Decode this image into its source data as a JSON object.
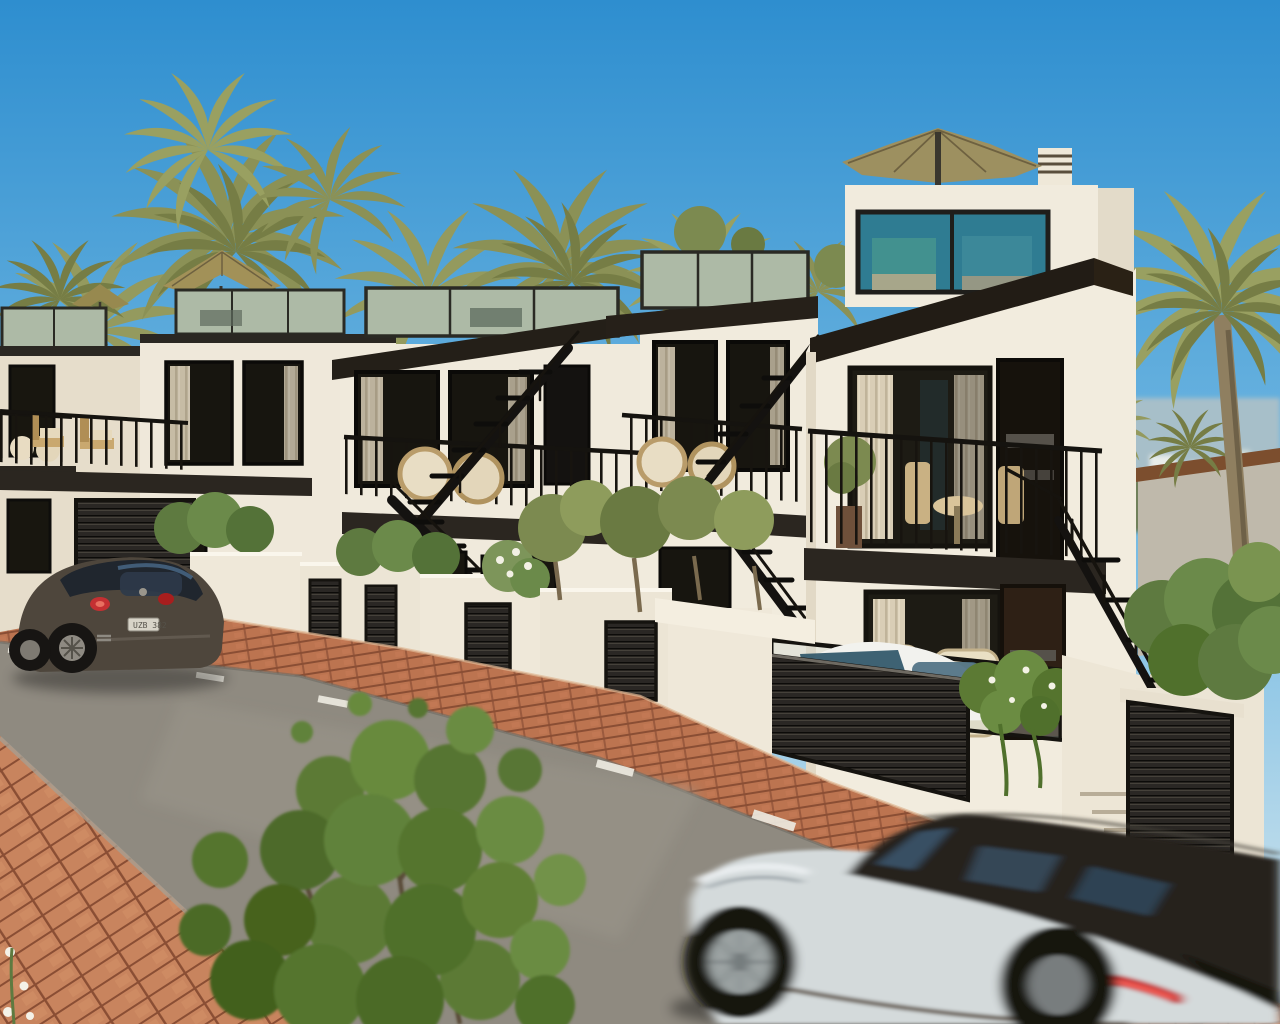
{
  "scene": {
    "type": "photorealistic architectural exterior render",
    "description": "Sunny daytime render of a row of modern white Mediterranean townhouses with rooftop glass terraces, tan patio umbrellas, black metal balconies and external stairs; date palms behind; brick-edged asphalt street in front with a dark VW Beetle parked at left, a motion-blurred white SUV driving past at lower right, and a leafy green bush at lower left.",
    "time_of_day": "bright sunny day",
    "sky": {
      "top": "#2e8ecf",
      "mid": "#7abde4",
      "horizon": "#dcead苏ee"
    }
  },
  "sky": {
    "top": "#2e8ecf",
    "mid": "#7abde4",
    "horizon": "#dceaee"
  },
  "palette": {
    "wall_light": "#f2ecde",
    "wall_shade": "#e6ddcb",
    "slab_dark": "#2b2620",
    "fascia_dark": "#221c15",
    "frame_dark": "#16130e",
    "window_glass": "#1d1b14",
    "glass_sage": "#adbaa6",
    "glass_teal": "#2f7c92",
    "umbrella_tan": "#9d9060",
    "umbrella_dark": "#8a7c4e",
    "palm_olive": "#949a5e",
    "palm_dark": "#767d45",
    "trunk_brown": "#8a7a5e",
    "hedge_green": "#5e7a40",
    "bush_green": "#5c7a34",
    "tree_olive": "#7c8a50",
    "road_asphalt": "#8f8a80",
    "road_dash": "#ece9df",
    "brick_curb": "#bc7450",
    "paver_salmon": "#c8845e",
    "joint_dark": "#8a4e34",
    "hill_blue": "#a7bfc9",
    "coping_brown": "#7c4e2e",
    "beetle_body": "#4e463c",
    "beetle_roof": "#20262e",
    "suv_body": "#d4dadb",
    "suv_glass": "#26241f",
    "taillight_red": "#c43032",
    "chair_cream": "#efe6ce",
    "rattan_tan": "#c9b183",
    "louver_dark": "#2a2724"
  },
  "vehicles": {
    "beetle": {
      "kind": "parked dark hatchback (Beetle style)",
      "plate": "UZB 382"
    },
    "suv": {
      "kind": "white SUV driving past, motion-blurred"
    }
  },
  "buildings": {
    "count": 5,
    "style": "modern cubic white townhouses stepping uphill to the right",
    "features": [
      "rooftop glass balustrades",
      "tan patio umbrellas",
      "black metal balcony railings",
      "external black staircases",
      "dark louvered garage and utility doors",
      "white planter walls with olive trees and hedges",
      "rattan patio furniture",
      "cream curtains behind dark-framed windows",
      "hanging plant with white flowers",
      "rooftop chimney"
    ]
  },
  "street": {
    "surface": "asphalt",
    "marking": "white dashed centerline",
    "edging": "salmon brick curb strip",
    "foreground": "salmon brick paver sidewalk"
  },
  "vegetation": [
    "date palm grove behind houses",
    "tall palm at right edge",
    "foreground leafy bush",
    "boxwood hedges",
    "olive trees in planters",
    "white flowering shrub"
  ]
}
